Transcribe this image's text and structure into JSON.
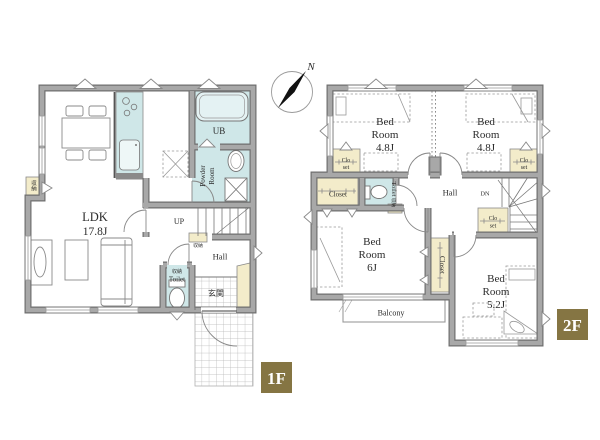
{
  "palette": {
    "wall_fill": "#a8a8a8",
    "wall_edge": "#6f6f6f",
    "wet_area": "#cfe7e8",
    "storage_area": "#f3ecca",
    "badge_bg": "#857543",
    "badge_text": "#ffffff",
    "label_text": "#2b2b2b"
  },
  "compass": {
    "north_label": "N"
  },
  "floor1": {
    "badge": "1F",
    "rooms": {
      "ldk": {
        "lines": [
          "LDK",
          "17.8J"
        ]
      },
      "ub": {
        "label": "UB"
      },
      "powder": {
        "lines": [
          "Powder",
          "Room"
        ]
      },
      "toilet": {
        "storage": "収納",
        "label": "Toilet"
      },
      "hall": {
        "label": "Hall"
      },
      "genkan": {
        "label": "玄関"
      },
      "stairs": {
        "label": "UP"
      },
      "storage_niche": {
        "label": "収納"
      },
      "storage_understairs": {
        "label": "収納"
      }
    }
  },
  "floor2": {
    "badge": "2F",
    "rooms": {
      "bedroom_nw": {
        "lines": [
          "Bed",
          "Room",
          "4.8J"
        ]
      },
      "bedroom_ne": {
        "lines": [
          "Bed",
          "Room",
          "4.8J"
        ]
      },
      "bedroom_sw": {
        "lines": [
          "Bed",
          "Room",
          "6J"
        ]
      },
      "bedroom_se": {
        "lines": [
          "Bed",
          "Room",
          "5.2J"
        ]
      },
      "closet_nw": {
        "lines": [
          "Clo",
          "set"
        ]
      },
      "closet_ne": {
        "lines": [
          "Clo",
          "set"
        ]
      },
      "closet_mid": {
        "lines": [
          "Clo",
          "set"
        ]
      },
      "closet_west": {
        "label": "Closet"
      },
      "closet_south": {
        "label": "Closet"
      },
      "toilet": {
        "label": "Toilet",
        "storage": "収納"
      },
      "hall": {
        "label": "Hall"
      },
      "stairs": {
        "label": "DN"
      },
      "balcony": {
        "label": "Balcony"
      }
    }
  }
}
